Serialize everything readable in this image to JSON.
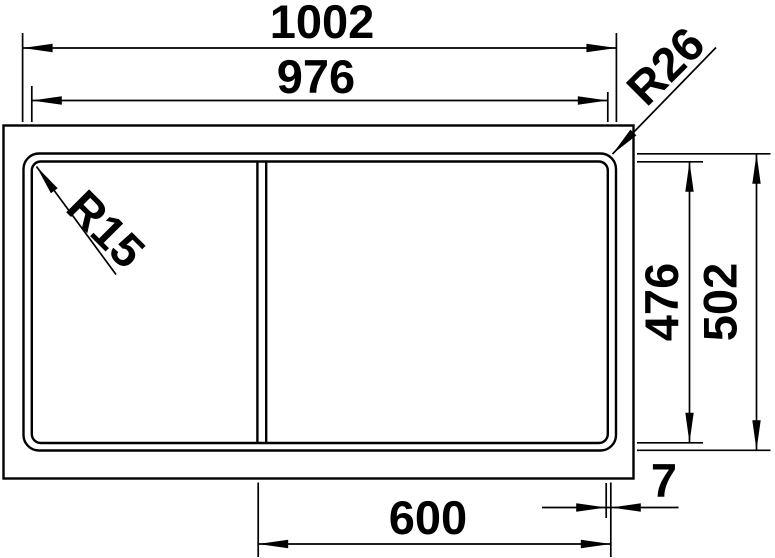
{
  "drawing": {
    "title": "sink-top-view-dimension-drawing",
    "background_color": "#ffffff",
    "line_color": "#000000",
    "dimensions": {
      "overall_width": "1002",
      "inner_width": "976",
      "bowl_width": "600",
      "edge_offset": "7",
      "inner_depth": "476",
      "overall_depth": "502",
      "outer_corner_radius": "R26",
      "inner_corner_radius": "R15"
    }
  }
}
